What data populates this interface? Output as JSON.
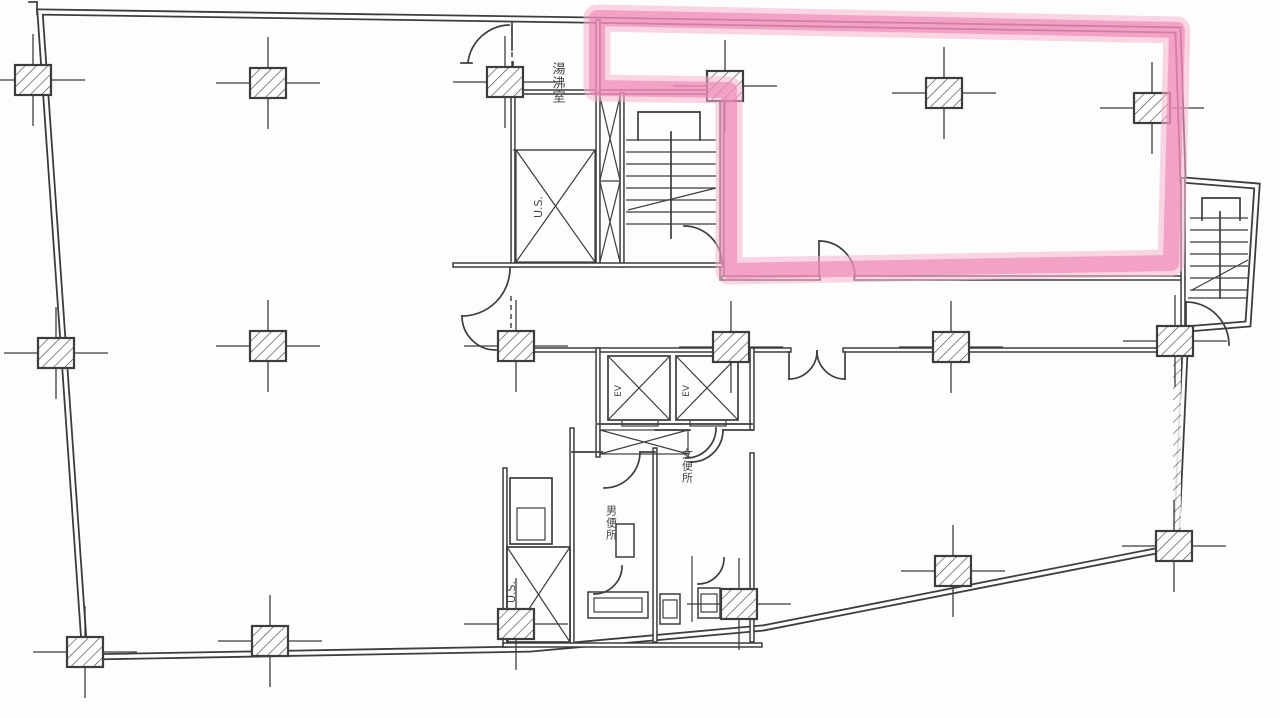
{
  "document": {
    "kind": "scanned architectural floor plan",
    "highlight_meaning": "outlined leasable suite (upper-right room)"
  },
  "colors": {
    "ink": "#3d3d3d",
    "paper": "#fdfdfb",
    "highlight_core": "#ee7fb0",
    "highlight_halo": "#f6b4d1"
  },
  "highlight": {
    "shape": "polygon-outline",
    "points": "597,18 1177,30 1171,263 729,271 729,90 597,88"
  },
  "labels": {
    "hot_water_room": "湯沸室",
    "upper_shaft": "U.S.",
    "lower_shaft": "U.S.",
    "elevator_left": "EV",
    "elevator_right": "EV",
    "mens_toilet": "男便所",
    "womens_toilet": "女便所"
  }
}
